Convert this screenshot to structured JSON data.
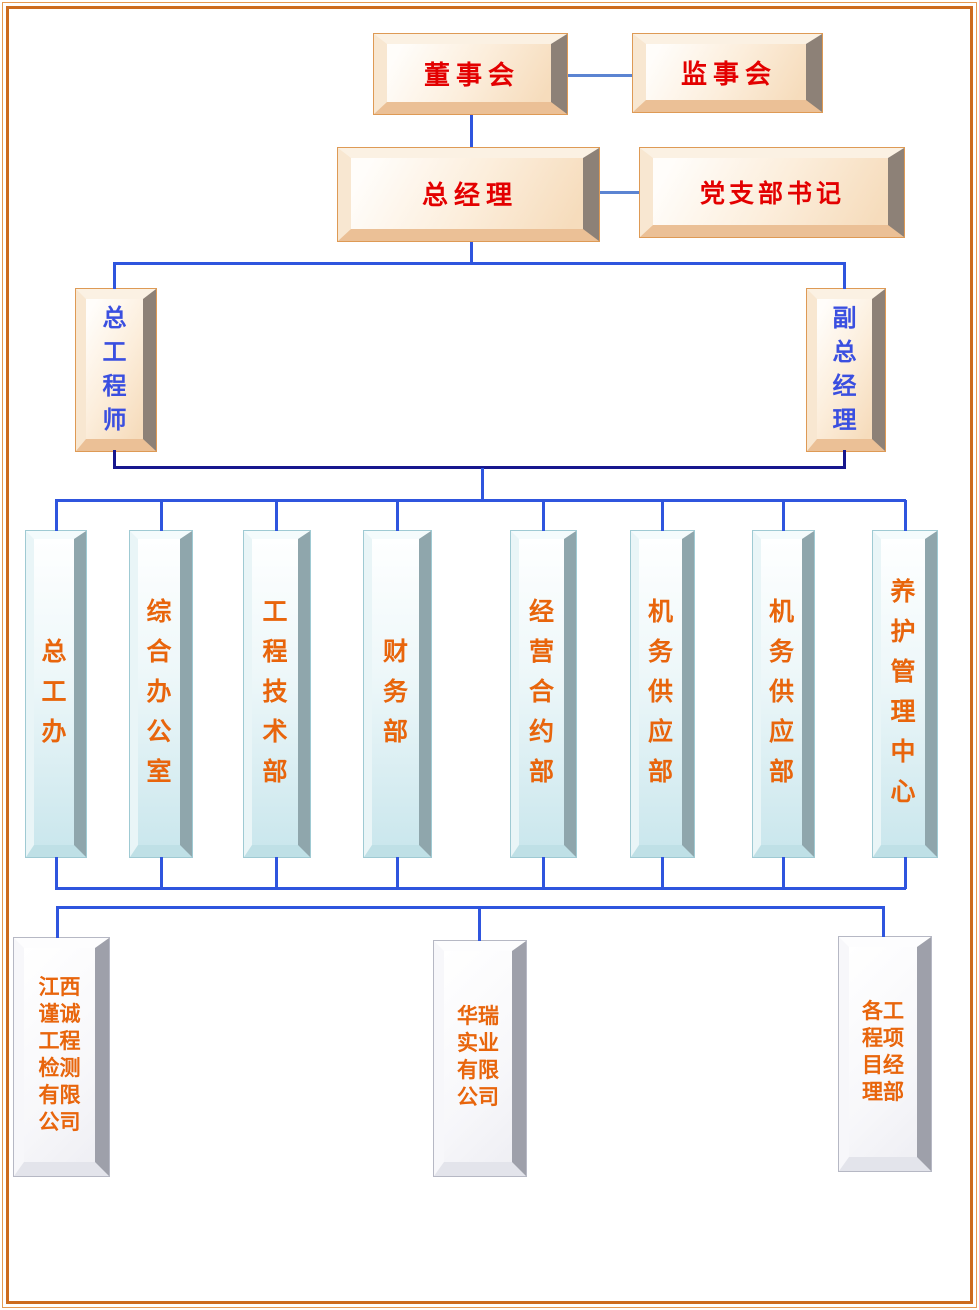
{
  "diagram": {
    "level1": [
      {
        "label": "董事会"
      },
      {
        "label": "监事会"
      }
    ],
    "level2": [
      {
        "label": "总经理"
      },
      {
        "label": "党支部书记"
      }
    ],
    "level3": [
      {
        "label": "总工程师"
      },
      {
        "label": "副总经理"
      }
    ],
    "departments": [
      {
        "label": "总工办"
      },
      {
        "label": "综合办公室"
      },
      {
        "label": "工程技术部"
      },
      {
        "label": "财务部"
      },
      {
        "label": "经营合约部"
      },
      {
        "label": "机务供应部"
      },
      {
        "label": "机务供应部"
      },
      {
        "label": "养护管理中心"
      }
    ],
    "subsidiaries": [
      {
        "label": "江西谨诚工程检测有限公司"
      },
      {
        "label": "华瑞实业有限公司"
      },
      {
        "label": "各工程项目经理部"
      }
    ],
    "colors": {
      "frame_orange": "#CC6B1E",
      "peach_box_border": "#DE9A55",
      "cyan_box_border": "#9FCAD3",
      "white_box_border": "#B6B8C4",
      "text_red": "#E30000",
      "text_blue": "#3A4FE0",
      "text_orange": "#E8650C",
      "line_blue": "#2F55DE",
      "line_navy": "#17178E",
      "line_steel": "#5B84D2"
    }
  }
}
